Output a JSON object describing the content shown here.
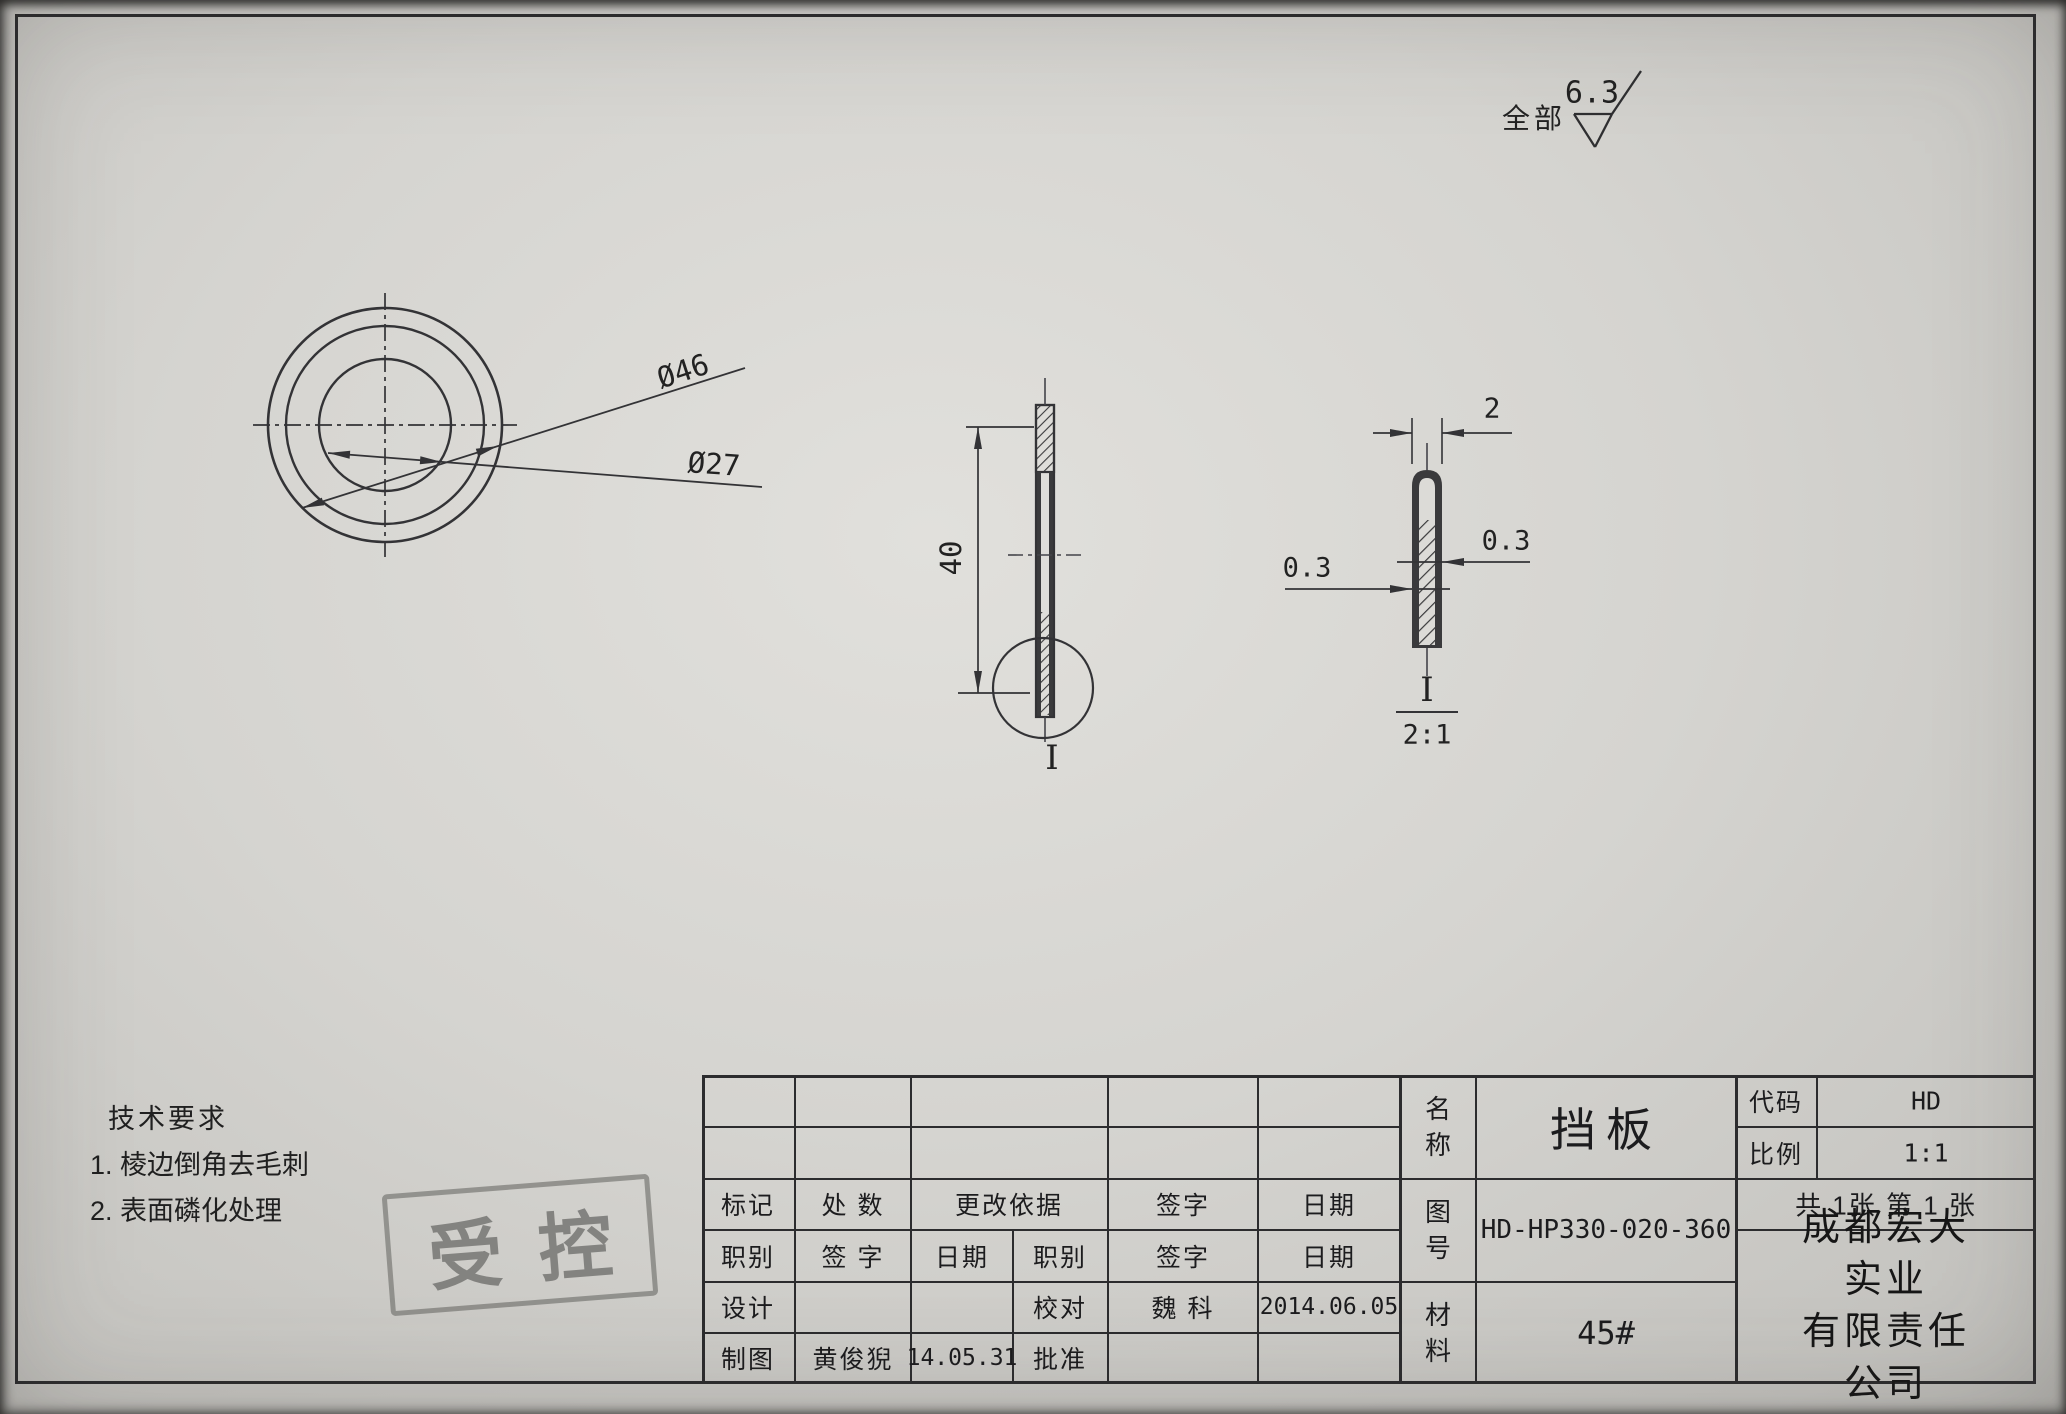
{
  "surface_finish": {
    "prefix": "全部",
    "value": "6.3"
  },
  "front_view": {
    "dia_outer": "Ø46",
    "dia_inner": "Ø27"
  },
  "side_view": {
    "height": "40",
    "detail_ref": "I"
  },
  "detail_view": {
    "width": "2",
    "thickness_right": "0.3",
    "thickness_left": "0.3",
    "ref": "I",
    "scale": "2:1"
  },
  "tech_requirements": {
    "title": "技术要求",
    "items": [
      "1. 棱边倒角去毛刺",
      "2. 表面磷化处理"
    ]
  },
  "stamp": {
    "text": "受控"
  },
  "title_block": {
    "revision_header": {
      "mark": "标记",
      "count": "处 数",
      "basis": "更改依据",
      "sign": "签字",
      "date": "日期"
    },
    "role_header": {
      "role1": "职别",
      "sign1": "签 字",
      "date1": "日期",
      "role2": "职别",
      "sign2": "签字",
      "date2": "日期"
    },
    "design_row": {
      "role1": "设计",
      "role2": "校对",
      "sign2": "魏  科",
      "date2": "2014.06.05"
    },
    "draft_row": {
      "role1": "制图",
      "sign1": "黄俊猊",
      "date1": "14.05.31",
      "role2": "批准"
    },
    "name_label": "名称",
    "name": "挡板",
    "code_label": "代码",
    "code": "HD",
    "scale_label": "比例",
    "scale": "1:1",
    "drawing_no_label": "图号",
    "drawing_no": "HD-HP330-020-360",
    "sheets": "共 1张   第 1 张",
    "material_label": "材料",
    "material": "45#",
    "company_line1": "成都宏大实业",
    "company_line2": "有限责任公司"
  }
}
